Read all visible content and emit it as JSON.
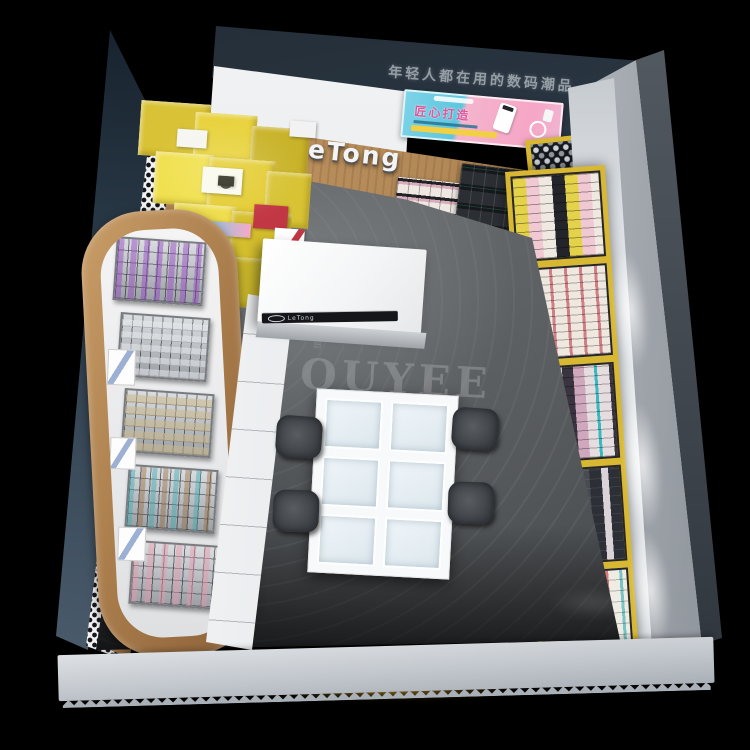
{
  "store": {
    "headline_sign": "年轻人都在用的数码潮品",
    "promo_banner": {
      "title": "匠心打造"
    },
    "brand": {
      "logo": "LeTong",
      "counter_label": "LeTong"
    },
    "floor_watermark": {
      "text": "OUYEE",
      "crown_icon": "♕"
    },
    "palette": {
      "background": "#000000",
      "exterior_wall": "#2e3a46",
      "accent_yellow": "#e5cf3a",
      "wood": "#b78f5d",
      "banner_blue": "#6fd0e6",
      "banner_pink": "#f5a9c7",
      "banner_title_color": "#e0569a",
      "gold_frame": "#d8b832",
      "floor_gray": "#54575a",
      "glass_cell": "#e7f0f6",
      "chair_gray": "#43474c"
    }
  }
}
